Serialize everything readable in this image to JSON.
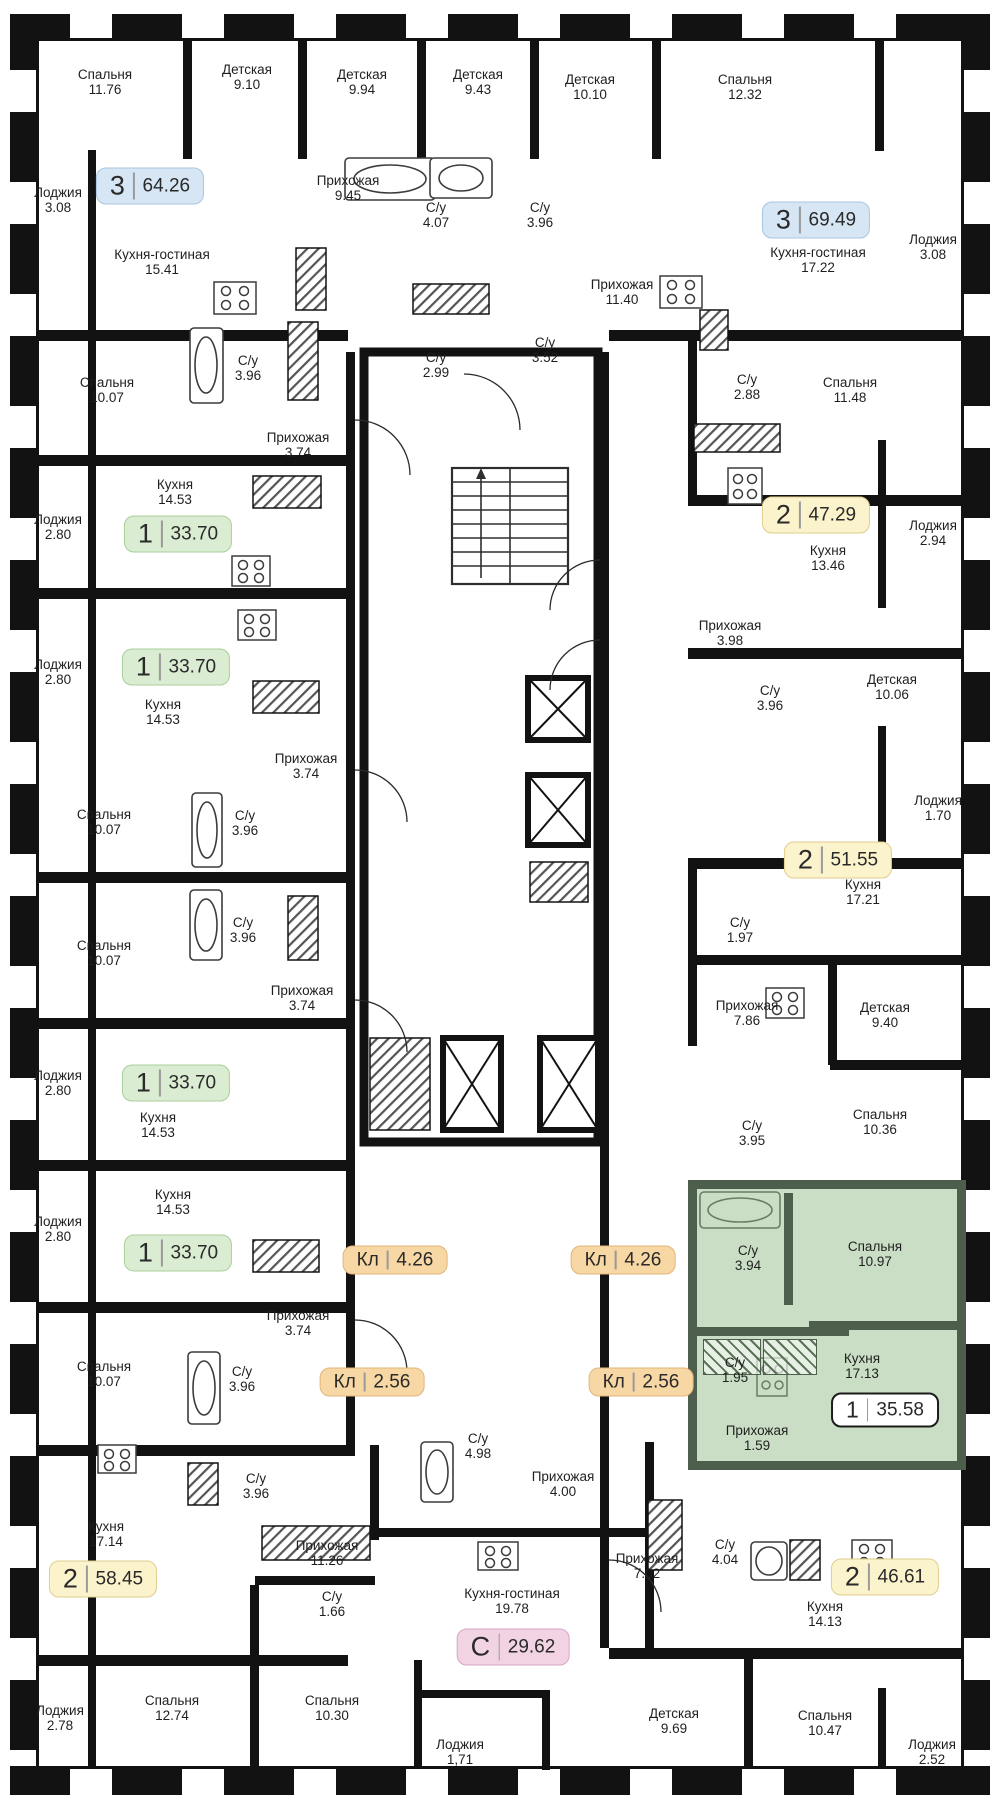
{
  "rooms": [
    {
      "n": "Спальня",
      "a": "11.76"
    },
    {
      "n": "Детская",
      "a": "9.10"
    },
    {
      "n": "Детская",
      "a": "9.94"
    },
    {
      "n": "Детская",
      "a": "9.43"
    },
    {
      "n": "Детская",
      "a": "10.10"
    },
    {
      "n": "Спальня",
      "a": "12.32"
    },
    {
      "n": "Лоджия",
      "a": "3.08"
    },
    {
      "n": "Кухня-гостиная",
      "a": "15.41"
    },
    {
      "n": "Прихожая",
      "a": "9.45"
    },
    {
      "n": "С/у",
      "a": "4.07"
    },
    {
      "n": "С/у",
      "a": "3.96"
    },
    {
      "n": "Прихожая",
      "a": "11.40"
    },
    {
      "n": "Кухня-гостиная",
      "a": "17.22"
    },
    {
      "n": "Лоджия",
      "a": "3.08"
    },
    {
      "n": "Спальня",
      "a": "10.07"
    },
    {
      "n": "С/у",
      "a": "3.96"
    },
    {
      "n": "С/у",
      "a": "2.99"
    },
    {
      "n": "С/у",
      "a": "3.52"
    },
    {
      "n": "С/у",
      "a": "2.88"
    },
    {
      "n": "Спальня",
      "a": "11.48"
    },
    {
      "n": "Прихожая",
      "a": "3.74"
    },
    {
      "n": "Кухня",
      "a": "14.53"
    },
    {
      "n": "Лоджия",
      "a": "2.80"
    },
    {
      "n": "Кухня",
      "a": "13.46"
    },
    {
      "n": "Лоджия",
      "a": "2.94"
    },
    {
      "n": "Прихожая",
      "a": "3.98"
    },
    {
      "n": "Лоджия",
      "a": "2.80"
    },
    {
      "n": "Кухня",
      "a": "14.53"
    },
    {
      "n": "С/у",
      "a": "3.96"
    },
    {
      "n": "Детская",
      "a": "10.06"
    },
    {
      "n": "Прихожая",
      "a": "3.74"
    },
    {
      "n": "Спальня",
      "a": "10.07"
    },
    {
      "n": "С/у",
      "a": "3.96"
    },
    {
      "n": "Лоджия",
      "a": "1.70"
    },
    {
      "n": "Кухня",
      "a": "17.21"
    },
    {
      "n": "С/у",
      "a": "1.97"
    },
    {
      "n": "Спальня",
      "a": "10.07"
    },
    {
      "n": "С/у",
      "a": "3.96"
    },
    {
      "n": "Прихожая",
      "a": "3.74"
    },
    {
      "n": "Прихожая",
      "a": "7.86"
    },
    {
      "n": "Детская",
      "a": "9.40"
    },
    {
      "n": "Лоджия",
      "a": "2.80"
    },
    {
      "n": "Кухня",
      "a": "14.53"
    },
    {
      "n": "Спальня",
      "a": "10.36"
    },
    {
      "n": "С/у",
      "a": "3.95"
    },
    {
      "n": "Кухня",
      "a": "14.53"
    },
    {
      "n": "Лоджия",
      "a": "2.80"
    },
    {
      "n": "Прихожая",
      "a": "3.74"
    },
    {
      "n": "С/у",
      "a": "3.94"
    },
    {
      "n": "Спальня",
      "a": "10.97"
    },
    {
      "n": "С/у",
      "a": "1.95"
    },
    {
      "n": "Кухня",
      "a": "17.13"
    },
    {
      "n": "Прихожая",
      "a": "1.59"
    },
    {
      "n": "Спальня",
      "a": "10.07"
    },
    {
      "n": "С/у",
      "a": "3.96"
    },
    {
      "n": "Кухня",
      "a": "17.14"
    },
    {
      "n": "С/у",
      "a": "3.96"
    },
    {
      "n": "Прихожая",
      "a": "11.26"
    },
    {
      "n": "С/у",
      "a": "4.98"
    },
    {
      "n": "Прихожая",
      "a": "4.00"
    },
    {
      "n": "С/у",
      "a": "1.66"
    },
    {
      "n": "Кухня-гостиная",
      "a": "19.78"
    },
    {
      "n": "Прихожая",
      "a": "7.02"
    },
    {
      "n": "С/у",
      "a": "4.04"
    },
    {
      "n": "Кухня",
      "a": "14.13"
    },
    {
      "n": "Лоджия",
      "a": "2.78"
    },
    {
      "n": "Спальня",
      "a": "12.74"
    },
    {
      "n": "Спальня",
      "a": "10.30"
    },
    {
      "n": "Лоджия",
      "a": "1,71"
    },
    {
      "n": "Детская",
      "a": "9.69"
    },
    {
      "n": "Спальня",
      "a": "10.47"
    },
    {
      "n": "Лоджия",
      "a": "2.52"
    }
  ],
  "badges": [
    {
      "t": "3",
      "a": "64.26"
    },
    {
      "t": "3",
      "a": "69.49"
    },
    {
      "t": "1",
      "a": "33.70"
    },
    {
      "t": "1",
      "a": "33.70"
    },
    {
      "t": "2",
      "a": "47.29"
    },
    {
      "t": "2",
      "a": "51.55"
    },
    {
      "t": "1",
      "a": "33.70"
    },
    {
      "t": "1",
      "a": "33.70"
    },
    {
      "t": "Кл",
      "a": "4.26"
    },
    {
      "t": "Кл",
      "a": "4.26"
    },
    {
      "t": "Кл",
      "a": "2.56"
    },
    {
      "t": "Кл",
      "a": "2.56"
    },
    {
      "t": "1",
      "a": "35.58"
    },
    {
      "t": "2",
      "a": "58.45"
    },
    {
      "t": "С",
      "a": "29.62"
    },
    {
      "t": "2",
      "a": "46.61"
    }
  ],
  "colors": {
    "walls": "#121212",
    "badge_3_rooms": "#d7e6f4",
    "badge_2_rooms": "#fbf3cc",
    "badge_1_room": "#daecd1",
    "badge_storage": "#f7d7a3",
    "badge_studio": "#f2d3e3",
    "highlight_fill": "#94be8a",
    "highlight_wall": "#4d5f4c"
  }
}
